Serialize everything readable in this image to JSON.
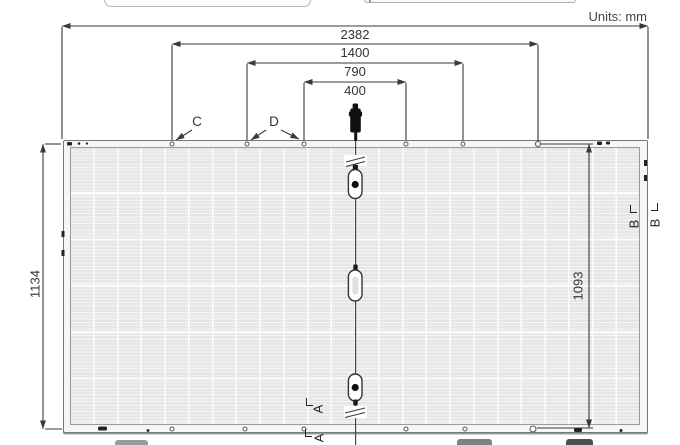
{
  "units_label": "Units: mm",
  "dimensions": {
    "total_width": {
      "value": "2382",
      "unit": "mm",
      "orientation": "horizontal"
    },
    "mount_span_outer": {
      "value": "1400",
      "unit": "mm",
      "orientation": "horizontal"
    },
    "mount_span_mid": {
      "value": "790",
      "unit": "mm",
      "orientation": "horizontal"
    },
    "mount_span_inner": {
      "value": "400",
      "unit": "mm",
      "orientation": "horizontal"
    },
    "total_height": {
      "value": "1134",
      "unit": "mm",
      "orientation": "vertical"
    },
    "mount_span_cross": {
      "value": "1093",
      "unit": "mm",
      "orientation": "vertical"
    }
  },
  "callouts": {
    "hole_c": "C",
    "hole_d": "D"
  },
  "sections": {
    "a_inner": "A",
    "a_outer": "A",
    "b_inner": "B",
    "b_outer": "B"
  },
  "panel": {
    "cell_columns": 24,
    "cell_rows": 6,
    "junction_boxes": 3,
    "cable_connectors": 1
  },
  "colors": {
    "line": "#3a3a3a",
    "cell": "#e9e9e9",
    "frame": "#f6f6f6",
    "frame_edge": "#777777",
    "connector_body": "#111111"
  }
}
